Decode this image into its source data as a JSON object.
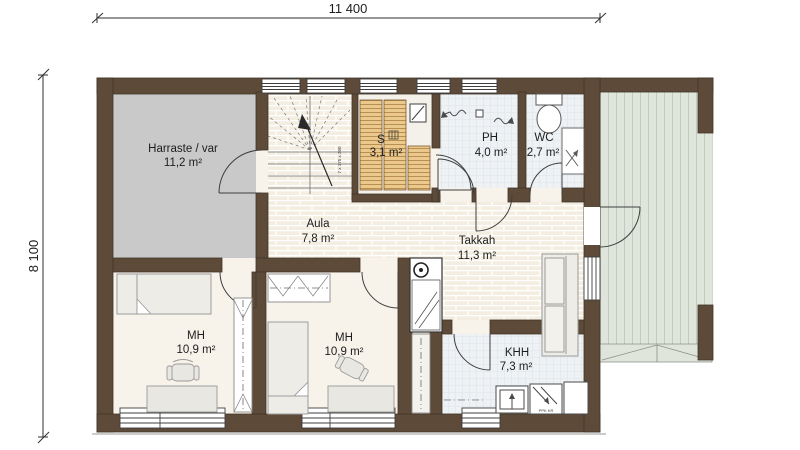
{
  "drawing_type": "floor-plan",
  "dimensions": {
    "width_mm": "11 400",
    "height_mm": "8 100"
  },
  "rooms": {
    "harraste": {
      "name": "Harraste / var",
      "area": "11,2 m²"
    },
    "aula": {
      "name": "Aula",
      "area": "7,8 m²"
    },
    "sauna": {
      "name": "S",
      "area": "3,1 m²"
    },
    "ph": {
      "name": "PH",
      "area": "4,0 m²"
    },
    "wc": {
      "name": "WC",
      "area": "2,7 m²"
    },
    "takkahuone": {
      "name": "Takkah",
      "area": "11,3 m²"
    },
    "mh1": {
      "name": "MH",
      "area": "10,9 m²"
    },
    "mh2": {
      "name": "MH",
      "area": "10,9 m²"
    },
    "khh": {
      "name": "KHH",
      "area": "7,3 m²"
    }
  },
  "annotations": {
    "stair_note": "7 x 175 x 260",
    "appliance_label": "PPK KR"
  },
  "colors": {
    "wall": "#5d4a39",
    "floor_gray": "#c9c9c9",
    "floor_brick": "#f3eee1",
    "floor_tile": "#eef2f5",
    "bench_wood": "#ebc88c",
    "floor_cream": "#f8f3ea",
    "deck_green": "#dfe5db",
    "line": "#3a3a3a"
  }
}
